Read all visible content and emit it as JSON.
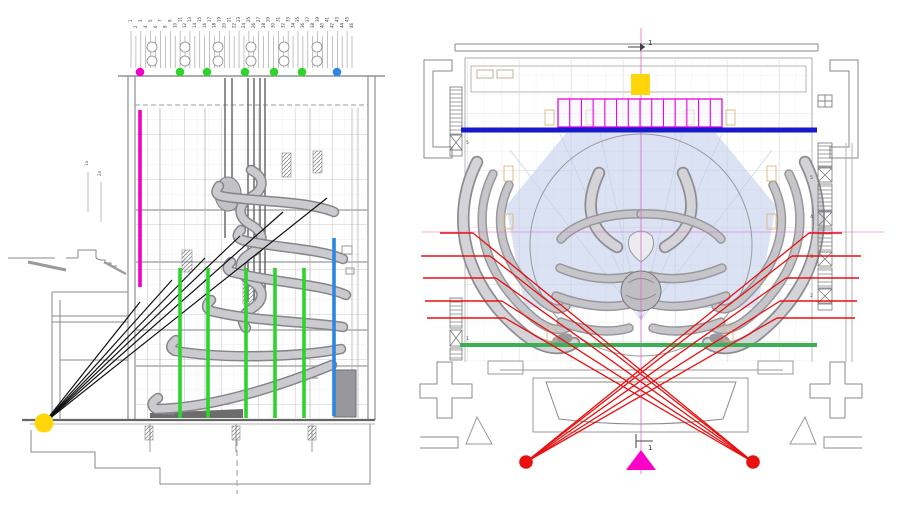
{
  "colors": {
    "magenta": "#F000C8",
    "magenta_band": "#E800E8",
    "magenta_triangle": "#FF00C8",
    "green": "#2ED32E",
    "green_line": "#3CAE54",
    "blue_light": "#2E86E0",
    "blue_dark": "#1818CC",
    "red": "#E81010",
    "yellow": "#FFD60A",
    "pink_centerline": "#E06BC8",
    "black_sightline": "#111111"
  },
  "section_view": {
    "fly_numbers": [
      "1",
      "2",
      "3",
      "4",
      "5",
      "6",
      "7",
      "8",
      "9",
      "10",
      "11",
      "12",
      "13",
      "14",
      "15",
      "16",
      "17",
      "18",
      "19",
      "20",
      "21",
      "22",
      "23",
      "24",
      "25",
      "26",
      "27",
      "28",
      "29",
      "30",
      "31",
      "32",
      "33",
      "34",
      "35",
      "36",
      "37",
      "38",
      "39",
      "40",
      "41",
      "42",
      "43",
      "44",
      "45",
      "46"
    ],
    "fly_ticks": {
      "x_start": 131,
      "x_end": 352,
      "count": 46
    },
    "pulley_columns": [
      152,
      185,
      218,
      251,
      284,
      317
    ],
    "dots_y": 72,
    "marker_dots": [
      {
        "x": 140,
        "color_key": "magenta"
      },
      {
        "x": 180,
        "color_key": "green"
      },
      {
        "x": 207,
        "color_key": "green"
      },
      {
        "x": 245,
        "color_key": "green"
      },
      {
        "x": 274,
        "color_key": "green"
      },
      {
        "x": 302,
        "color_key": "green"
      },
      {
        "x": 337,
        "color_key": "blue_light"
      }
    ],
    "highlight_lines": [
      {
        "x": 140,
        "y1": 110,
        "y2": 287,
        "color_key": "magenta"
      },
      {
        "x": 180,
        "y1": 268,
        "y2": 418,
        "color_key": "green"
      },
      {
        "x": 208,
        "y1": 268,
        "y2": 418,
        "color_key": "green"
      },
      {
        "x": 246,
        "y1": 268,
        "y2": 418,
        "color_key": "green"
      },
      {
        "x": 275,
        "y1": 268,
        "y2": 418,
        "color_key": "green"
      },
      {
        "x": 304,
        "y1": 268,
        "y2": 418,
        "color_key": "green"
      },
      {
        "x": 334,
        "y1": 238,
        "y2": 416,
        "color_key": "blue_light"
      }
    ],
    "sightline_origin": {
      "x": 44,
      "y": 423
    },
    "sightline_targets": [
      [
        327,
        198
      ],
      [
        283,
        212
      ],
      [
        240,
        236
      ],
      [
        205,
        258
      ],
      [
        172,
        280
      ],
      [
        140,
        302
      ]
    ],
    "viewpoint_marker": {
      "x": 44,
      "y": 423,
      "r": 9.5,
      "color_key": "yellow"
    },
    "level_labels": [
      {
        "text": "1a",
        "x": 88,
        "y": 166
      },
      {
        "text": "2a",
        "x": 101,
        "y": 176
      }
    ]
  },
  "plan_view": {
    "section_marker_label": "1",
    "yellow_square": {
      "x": 631,
      "y": 74,
      "w": 19,
      "h": 21
    },
    "magenta_band": {
      "x1": 558,
      "x2": 722,
      "y1": 99,
      "y2": 127,
      "cells": 14
    },
    "blue_line": {
      "x1": 461,
      "x2": 817,
      "y": 130,
      "width": 5
    },
    "green_line": {
      "x1": 460,
      "x2": 817,
      "y": 345,
      "width": 4
    },
    "red_dots": [
      {
        "x": 526,
        "y": 462
      },
      {
        "x": 753,
        "y": 462
      }
    ],
    "red_ticks_left": [
      [
        440,
        473,
        233
      ],
      [
        421,
        490,
        256
      ],
      [
        423,
        496,
        278
      ],
      [
        425,
        502,
        301
      ],
      [
        427,
        505,
        318
      ]
    ],
    "red_ticks_right": [
      [
        842,
        809,
        233
      ],
      [
        861,
        792,
        256
      ],
      [
        859,
        786,
        278
      ],
      [
        857,
        780,
        301
      ],
      [
        855,
        777,
        318
      ]
    ],
    "triangle": {
      "cx": 641,
      "top_y": 450,
      "base_y": 470,
      "half_w": 15
    },
    "centerline_v": {
      "x": 641,
      "y1": 28,
      "y2": 474
    },
    "centerline_h": {
      "y": 232,
      "x1": 422,
      "x2": 884
    },
    "ladder_labels_right": [
      {
        "text": "5",
        "x": 813,
        "y": 179
      },
      {
        "text": "4",
        "x": 813,
        "y": 218
      },
      {
        "text": "3",
        "x": 813,
        "y": 258
      },
      {
        "text": "2",
        "x": 813,
        "y": 297
      }
    ],
    "ladder_labels_left": [
      {
        "text": "5",
        "x": 466,
        "y": 144
      },
      {
        "text": "1",
        "x": 466,
        "y": 340
      }
    ]
  }
}
